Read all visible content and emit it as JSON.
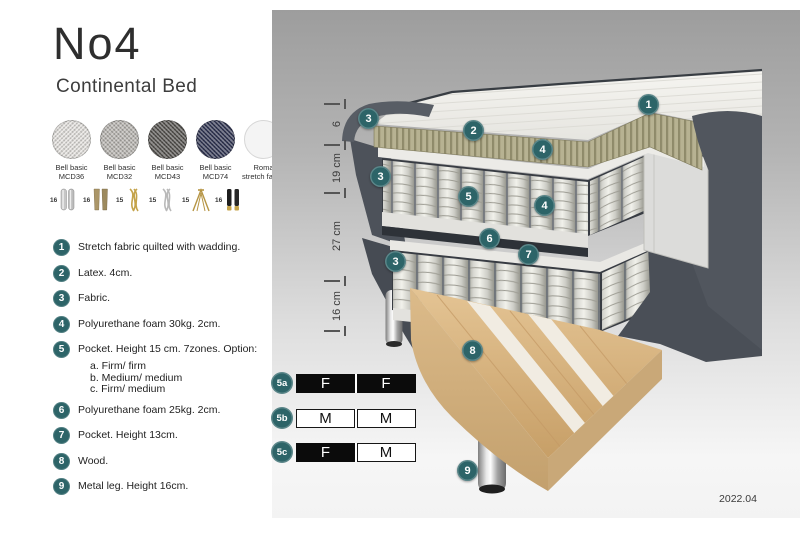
{
  "header": {
    "title": "No4",
    "subtitle": "Continental Bed"
  },
  "fabric_swatches": [
    {
      "line1": "Bell basic",
      "line2": "MCD36",
      "color": "#e6e4e0"
    },
    {
      "line1": "Bell basic",
      "line2": "MCD32",
      "color": "#b9b6b1"
    },
    {
      "line1": "Bell basic",
      "line2": "MCD43",
      "color": "#55534f"
    },
    {
      "line1": "Bell basic",
      "line2": "MCD74",
      "color": "#2f3452"
    },
    {
      "line1": "Roma",
      "line2": "stretch fabric",
      "color": "#f4f4f4"
    }
  ],
  "leg_options": [
    {
      "height": "16",
      "type": "cylinder-chrome"
    },
    {
      "height": "16",
      "type": "block-wood"
    },
    {
      "height": "15",
      "type": "twist-gold"
    },
    {
      "height": "15",
      "type": "twist-silver"
    },
    {
      "height": "15",
      "type": "hairpin-gold"
    },
    {
      "height": "16",
      "type": "cylinder-black-gold"
    }
  ],
  "spec_list": [
    {
      "num": "1",
      "text": "Stretch fabric quilted with wadding."
    },
    {
      "num": "2",
      "text": "Latex. 4cm."
    },
    {
      "num": "3",
      "text": "Fabric."
    },
    {
      "num": "4",
      "text": "Polyurethane foam 30kg. 2cm."
    },
    {
      "num": "5",
      "text": "Pocket. Height 15 cm. 7zones. Option:",
      "options": [
        "a. Firm/ firm",
        "b. Medium/ medium",
        "c. Firm/ medium"
      ]
    },
    {
      "num": "6",
      "text": "Polyurethane foam 25kg. 2cm."
    },
    {
      "num": "7",
      "text": "Pocket. Height 13cm."
    },
    {
      "num": "8",
      "text": "Wood."
    },
    {
      "num": "9",
      "text": "Metal leg. Height 16cm."
    }
  ],
  "dimensions": [
    "6",
    "19 cm",
    "27 cm",
    "16 cm"
  ],
  "callouts": [
    "1",
    "2",
    "3",
    "3",
    "3",
    "4",
    "4",
    "5",
    "6",
    "7",
    "8",
    "9"
  ],
  "firmness_rows": [
    {
      "id": "5a",
      "left": {
        "label": "F",
        "style": "dark"
      },
      "right": {
        "label": "F",
        "style": "dark"
      }
    },
    {
      "id": "5b",
      "left": {
        "label": "M",
        "style": "light"
      },
      "right": {
        "label": "M",
        "style": "light"
      }
    },
    {
      "id": "5c",
      "left": {
        "label": "F",
        "style": "dark"
      },
      "right": {
        "label": "M",
        "style": "light"
      }
    }
  ],
  "colors": {
    "badge_teal": "#2d6468",
    "cell_dark": "#0b0b0b",
    "cell_light": "#ffffff"
  },
  "meta": {
    "version_label": "2022.04"
  }
}
